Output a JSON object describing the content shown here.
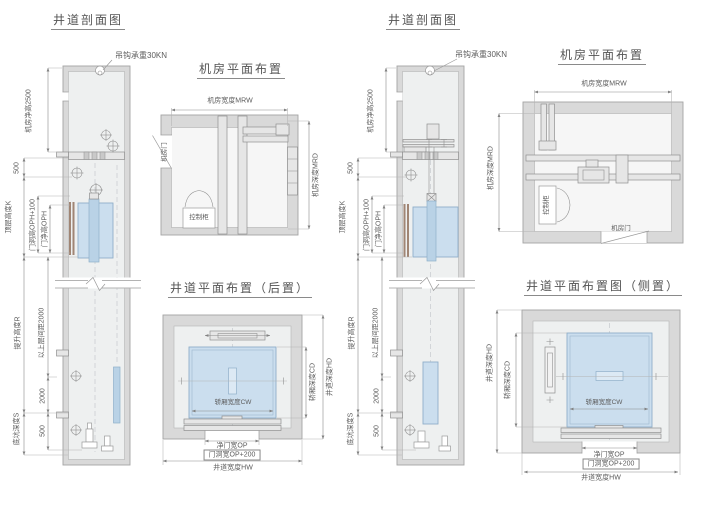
{
  "left": {
    "section": {
      "title": "井道剖面图",
      "hook_note": "吊钩承重30KN",
      "machine_room_clear_height": "机房净高2500",
      "dim_500_top": "500",
      "top_floor_height": "顶层高度K",
      "door_opening_height": "门洞高OPH+100",
      "door_clear_height": "门净高OPH",
      "travel_height": "提升高度R",
      "upper_floor_spacing": "以上层间距2000",
      "dim_2000": "2000",
      "pit_depth": "底坑深度S",
      "dim_500_bottom": "500"
    },
    "machine_room": {
      "title": "机房平面布置",
      "width": "机房宽度MRW",
      "depth": "机房深度MRD",
      "door": "机房门",
      "control_cabinet": "控制柜"
    },
    "shaft_plan": {
      "title": "井道平面布置（后置）",
      "car_width": "轿厢宽度CW",
      "car_depth": "轿厢深度CD",
      "shaft_depth": "井道深度HD",
      "door_clear_width": "净门宽OP",
      "door_opening_width": "门洞宽OP+200",
      "shaft_width": "井道宽度HW"
    }
  },
  "right": {
    "section": {
      "title": "井道剖面图",
      "hook_note": "吊钩承重30KN",
      "machine_room_clear_height": "机房净高2500",
      "dim_500_top": "500",
      "top_floor_height": "顶层高度K",
      "door_opening_height": "门洞高OPH+100",
      "door_clear_height": "门净高OPH",
      "travel_height": "提升高度R",
      "upper_floor_spacing": "以上层间距2000",
      "dim_2000": "2000",
      "pit_depth": "底坑深度S",
      "dim_500_bottom": "500"
    },
    "machine_room": {
      "title": "机房平面布置",
      "width": "机房宽度MRW",
      "depth": "机房深度MRD",
      "door": "机房门",
      "control_cabinet": "控制柜"
    },
    "shaft_plan": {
      "title": "井道平面布置图（侧置）",
      "car_width": "轿厢宽度CW",
      "car_depth": "轿厢深度CD",
      "shaft_depth": "井道深度HD",
      "door_clear_width": "净门宽OP",
      "door_opening_width": "门洞宽OP+200",
      "shaft_width": "井道宽度HW"
    }
  }
}
